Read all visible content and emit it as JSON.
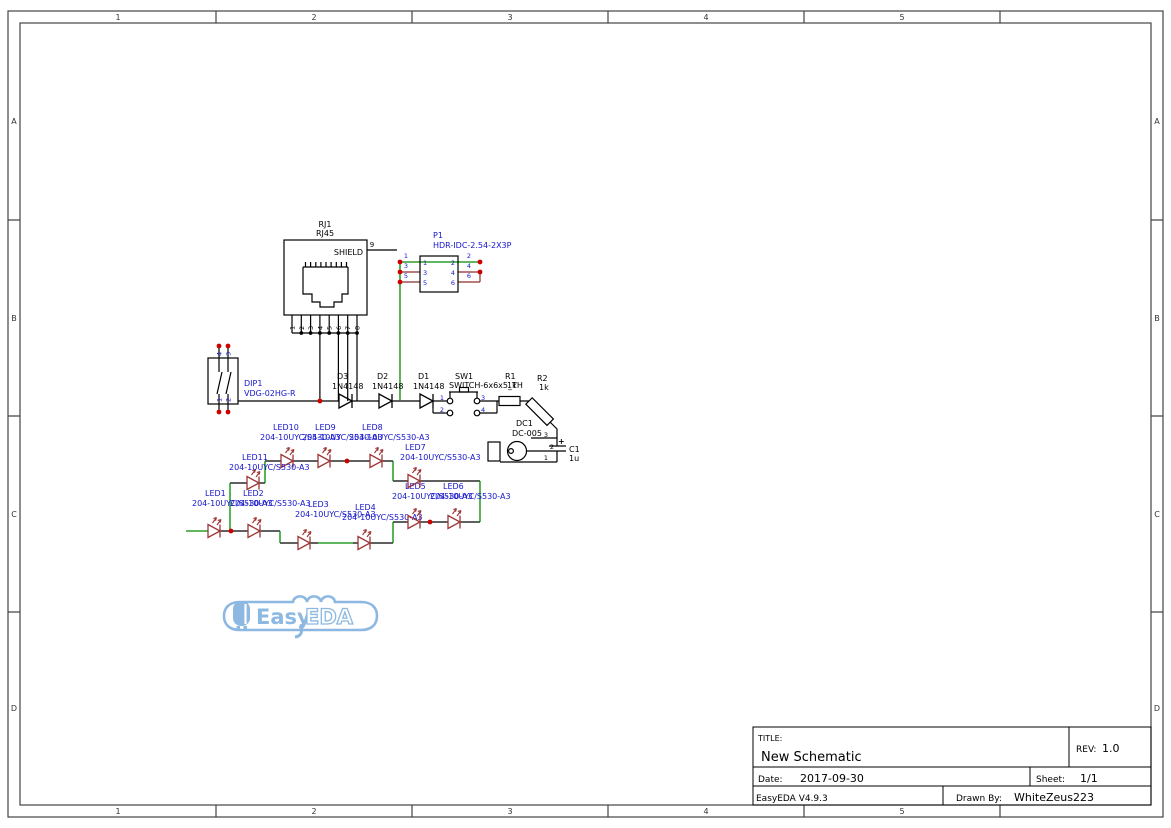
{
  "frame": {
    "cols": [
      "1",
      "2",
      "3",
      "4",
      "5"
    ],
    "rows": [
      "A",
      "B",
      "C",
      "D"
    ]
  },
  "title_block": {
    "title_label": "TITLE:",
    "title": "New Schematic",
    "rev_label": "REV:",
    "rev": "1.0",
    "date_label": "Date:",
    "date": "2017-09-30",
    "sheet_label": "Sheet:",
    "sheet": "1/1",
    "version": "EasyEDA V4.9.3",
    "drawn_by_label": "Drawn By:",
    "drawn_by": "WhiteZeus223"
  },
  "logo": {
    "text_left": "Easy",
    "text_right": "EDA"
  },
  "components": {
    "rj1": {
      "ref": "RJ1",
      "value": "RJ45",
      "shield": "SHIELD",
      "pin9": "9",
      "pins": [
        "1",
        "2",
        "3",
        "4",
        "5",
        "6",
        "7",
        "8"
      ]
    },
    "p1": {
      "ref": "P1",
      "value": "HDR-IDC-2.54-2X3P",
      "left_pins": [
        "1",
        "3",
        "5"
      ],
      "right_pins": [
        "2",
        "4",
        "6"
      ]
    },
    "dip1": {
      "ref": "DIP1",
      "value": "VDG-02HG-R",
      "pins_top": [
        "4",
        "3"
      ],
      "pins_bottom": [
        "1",
        "2"
      ]
    },
    "d3": {
      "ref": "D3",
      "value": "1N4148"
    },
    "d2": {
      "ref": "D2",
      "value": "1N4148"
    },
    "d1": {
      "ref": "D1",
      "value": "1N4148"
    },
    "sw1": {
      "ref": "SW1",
      "value": "SWITCH-6x6x5_TH",
      "pins": [
        "1",
        "2",
        "3",
        "4"
      ]
    },
    "r1": {
      "ref": "R1",
      "value": "1k"
    },
    "r2": {
      "ref": "R2",
      "value": "1k"
    },
    "dc1": {
      "ref": "DC1",
      "value": "DC-005",
      "pins": [
        "3",
        "2",
        "1"
      ]
    },
    "c1": {
      "ref": "C1",
      "value": "1u",
      "plus": "+"
    },
    "leds": [
      {
        "ref": "LED1",
        "value": "204-10UYC/S530-A3"
      },
      {
        "ref": "LED2",
        "value": "204-10UYC/S530-A3"
      },
      {
        "ref": "LED3",
        "value": "204-10UYC/S530-A3"
      },
      {
        "ref": "LED4",
        "value": "204-10UYC/S530-A3"
      },
      {
        "ref": "LED5",
        "value": "204-10UYC/S530-A3"
      },
      {
        "ref": "LED6",
        "value": "204-10UYC/S530-A3"
      },
      {
        "ref": "LED7",
        "value": "204-10UYC/S530-A3"
      },
      {
        "ref": "LED8",
        "value": "204-10UYC/S530-A3"
      },
      {
        "ref": "LED9",
        "value": "204-10UYC/S530-A3"
      },
      {
        "ref": "LED10",
        "value": "204-10UYC/S530-A3"
      },
      {
        "ref": "LED11",
        "value": "204-10UYC/S530-A3"
      }
    ]
  },
  "colors": {
    "wire_green": "#008c00",
    "pin_maroon": "#8b2e2e",
    "led_red": "#9e3535",
    "junction_red": "#cc0000",
    "label_blue": "#1414cc",
    "line_black": "#000000",
    "logo_blue": "#8cb8e2"
  }
}
